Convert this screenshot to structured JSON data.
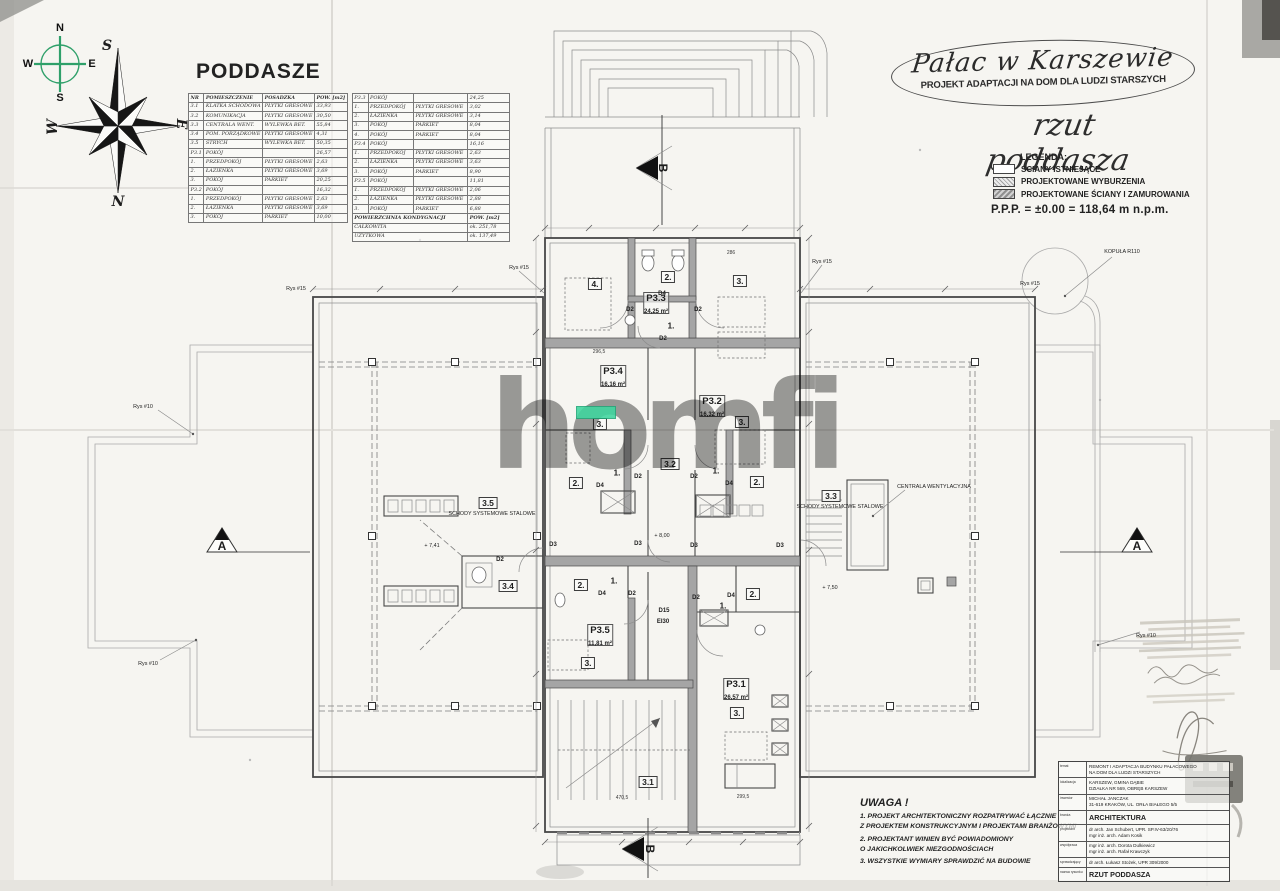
{
  "colors": {
    "highlight_green": "#3fd69f",
    "compass_green": "#2fa06a",
    "watermark_gray": "#868686"
  },
  "compass": {
    "n": "N",
    "e": "E",
    "s": "S",
    "w": "W"
  },
  "attic_table": {
    "title": "PODDASZE",
    "headers": [
      "NR",
      "POMIESZCZENIE",
      "POSADZKA",
      "POW. [m2]"
    ],
    "left_rows": [
      [
        "3.1",
        "KLATKA SCHODOWA",
        "PŁYTKI GRESOWE",
        "33,93"
      ],
      [
        "3.2",
        "KOMUNIKACJA",
        "PŁYTKI GRESOWE",
        "30,50"
      ],
      [
        "3.3",
        "CENTRALA WENT.",
        "WYLEWKA BET.",
        "55,84"
      ],
      [
        "3.4",
        "POM. PORZĄDKOWE",
        "PŁYTKI GRESOWE",
        "4,31"
      ],
      [
        "3.5",
        "STRYCH",
        "WYLEWKA BET.",
        "50,35"
      ],
      [
        "P3.1",
        "POKÓJ",
        "",
        "26,57"
      ],
      [
        "1.",
        "PRZEDPOKÓJ",
        "PŁYTKI GRESOWE",
        "2,63"
      ],
      [
        "2.",
        "ŁAZIENKA",
        "PŁYTKI GRESOWE",
        "3,69"
      ],
      [
        "3.",
        "POKÓJ",
        "PARKIET",
        "20,25"
      ],
      [
        "P3.2",
        "POKÓJ",
        "",
        "16,32"
      ],
      [
        "1.",
        "PRZEDPOKÓJ",
        "PŁYTKI GRESOWE",
        "2,63"
      ],
      [
        "2.",
        "ŁAZIENKA",
        "PŁYTKI GRESOWE",
        "3,69"
      ],
      [
        "3.",
        "POKÓJ",
        "PARKIET",
        "10,00"
      ]
    ],
    "right_rows": [
      [
        "P3.3",
        "POKÓJ",
        "",
        "24,25"
      ],
      [
        "1.",
        "PRZEDPOKÓJ",
        "PŁYTKI GRESOWE",
        "3,02"
      ],
      [
        "2.",
        "ŁAZIENKA",
        "PŁYTKI GRESOWE",
        "3,14"
      ],
      [
        "3.",
        "POKÓJ",
        "PARKIET",
        "8,04"
      ],
      [
        "4.",
        "POKÓJ",
        "PARKIET",
        "8,04"
      ],
      [
        "P3.4",
        "POKÓJ",
        "",
        "16,16"
      ],
      [
        "1.",
        "PRZEDPOKÓJ",
        "PŁYTKI GRESOWE",
        "2,63"
      ],
      [
        "2.",
        "ŁAZIENKA",
        "PŁYTKI GRESOWE",
        "3,63"
      ],
      [
        "3.",
        "POKÓJ",
        "PARKIET",
        "8,90"
      ],
      [
        "P3.5",
        "POKÓJ",
        "",
        "11,81"
      ],
      [
        "1.",
        "PRZEDPOKÓJ",
        "PŁYTKI GRESOWE",
        "2,06"
      ],
      [
        "2.",
        "ŁAZIENKA",
        "PŁYTKI GRESOWE",
        "2,88"
      ],
      [
        "3.",
        "POKÓJ",
        "PARKIET",
        "6,88"
      ]
    ],
    "summary": {
      "head": "POWIERZCHNIA KONDYGNACJI",
      "unit": "POW. [m2]",
      "rows": [
        [
          "CAŁKOWITA",
          "ok. 251,78"
        ],
        [
          "UŻYTKOWA",
          "ok. 137,49"
        ]
      ]
    }
  },
  "header": {
    "project_title": "Pałac w Karszewie",
    "project_subtitle": "PROJEKT ADAPTACJI NA DOM DLA LUDZI STARSZYCH",
    "drawing_title": "rzut poddasza",
    "legend": {
      "title": "LEGENDA:",
      "items": [
        {
          "label": "ŚCIANY ISTNIEJĄCE",
          "cls": "existing"
        },
        {
          "label": "PROJEKTOWANE WYBURZENIA",
          "cls": "demolition"
        },
        {
          "label": "PROJEKTOWANE ŚCIANY I ZAMUROWANIA",
          "cls": "newwalls"
        }
      ]
    },
    "level_note": "P.P.P. =  ±0.00 = 118,64 m n.p.m."
  },
  "plan": {
    "watermark": "homfi",
    "labels": [
      {
        "text": "S",
        "x": 107,
        "y": 46,
        "cls": "bl"
      },
      {
        "text": "N",
        "x": 118,
        "y": 202,
        "cls": "bl"
      },
      {
        "text": "W",
        "x": 53,
        "y": 127,
        "cls": "bl rotneg"
      },
      {
        "text": "E",
        "x": 181,
        "y": 124,
        "cls": "bl rot"
      },
      {
        "text": "Rys #15",
        "x": 296,
        "y": 289,
        "cls": "tiny"
      },
      {
        "text": "Rys #15",
        "x": 519,
        "y": 268,
        "cls": "tiny"
      },
      {
        "text": "Rys #15",
        "x": 822,
        "y": 262,
        "cls": "tiny"
      },
      {
        "text": "Rys #15",
        "x": 1030,
        "y": 284,
        "cls": "tiny"
      },
      {
        "text": "KOPUŁA R110",
        "x": 1122,
        "y": 252,
        "cls": "tiny"
      },
      {
        "text": "Rys #10",
        "x": 143,
        "y": 407,
        "cls": "tiny"
      },
      {
        "text": "Rys #10",
        "x": 148,
        "y": 664,
        "cls": "tiny"
      },
      {
        "text": "Rys #10",
        "x": 1146,
        "y": 636,
        "cls": "tiny"
      },
      {
        "text": "4.",
        "x": 595,
        "y": 284,
        "cls": "boxed"
      },
      {
        "text": "2.",
        "x": 668,
        "y": 277,
        "cls": "boxed"
      },
      {
        "text": "3.",
        "x": 740,
        "y": 281,
        "cls": "boxed"
      },
      {
        "text": "P3.3",
        "x": 656,
        "y": 303,
        "cls": "rm"
      },
      {
        "text": "24,25 m²",
        "x": 656,
        "y": 312,
        "cls": "area"
      },
      {
        "text": "D4",
        "x": 662,
        "y": 294,
        "cls": "dlab"
      },
      {
        "text": "D2",
        "x": 630,
        "y": 310,
        "cls": "dlab"
      },
      {
        "text": "D2",
        "x": 698,
        "y": 310,
        "cls": "dlab"
      },
      {
        "text": "1.",
        "x": 671,
        "y": 326,
        "cls": "num"
      },
      {
        "text": "D2",
        "x": 663,
        "y": 339,
        "cls": "dlab"
      },
      {
        "text": "296,5",
        "x": 599,
        "y": 352,
        "cls": "dim"
      },
      {
        "text": "286",
        "x": 731,
        "y": 253,
        "cls": "dim"
      },
      {
        "text": "P3.4",
        "x": 613,
        "y": 376,
        "cls": "rm"
      },
      {
        "text": "16,16 m²",
        "x": 613,
        "y": 385,
        "cls": "area"
      },
      {
        "text": "P3.2",
        "x": 712,
        "y": 406,
        "cls": "rm"
      },
      {
        "text": "16,32 m²",
        "x": 712,
        "y": 415,
        "cls": "area"
      },
      {
        "text": "3.",
        "x": 600,
        "y": 424,
        "cls": "boxed"
      },
      {
        "text": "3.",
        "x": 742,
        "y": 422,
        "cls": "boxed"
      },
      {
        "text": "3.2",
        "x": 670,
        "y": 464,
        "cls": "boxed"
      },
      {
        "text": "2.",
        "x": 576,
        "y": 483,
        "cls": "boxed"
      },
      {
        "text": "1.",
        "x": 617,
        "y": 473,
        "cls": "num"
      },
      {
        "text": "D4",
        "x": 600,
        "y": 486,
        "cls": "dlab"
      },
      {
        "text": "D2",
        "x": 638,
        "y": 477,
        "cls": "dlab"
      },
      {
        "text": "D2",
        "x": 694,
        "y": 477,
        "cls": "dlab"
      },
      {
        "text": "1.",
        "x": 716,
        "y": 471,
        "cls": "num"
      },
      {
        "text": "D4",
        "x": 729,
        "y": 484,
        "cls": "dlab"
      },
      {
        "text": "2.",
        "x": 757,
        "y": 482,
        "cls": "boxed"
      },
      {
        "text": "+ 8,00",
        "x": 662,
        "y": 536,
        "cls": "tiny"
      },
      {
        "text": "D3",
        "x": 553,
        "y": 545,
        "cls": "dlab"
      },
      {
        "text": "D3",
        "x": 638,
        "y": 544,
        "cls": "dlab"
      },
      {
        "text": "D3",
        "x": 694,
        "y": 546,
        "cls": "dlab"
      },
      {
        "text": "D3",
        "x": 780,
        "y": 546,
        "cls": "dlab"
      },
      {
        "text": "3.5",
        "x": 488,
        "y": 503,
        "cls": "boxed"
      },
      {
        "text": "SCHODY SYSTEMOWE STALOWE",
        "x": 492,
        "y": 514,
        "cls": "tiny"
      },
      {
        "text": "+ 7,41",
        "x": 432,
        "y": 546,
        "cls": "tiny"
      },
      {
        "text": "D2",
        "x": 500,
        "y": 560,
        "cls": "dlab"
      },
      {
        "text": "3.4",
        "x": 508,
        "y": 586,
        "cls": "boxed"
      },
      {
        "text": "3.3",
        "x": 831,
        "y": 496,
        "cls": "boxed"
      },
      {
        "text": "SCHODY SYSTEMOWE STALOWE",
        "x": 840,
        "y": 507,
        "cls": "tiny"
      },
      {
        "text": "CENTRALA WENTYLACYJNA",
        "x": 934,
        "y": 487,
        "cls": "tiny"
      },
      {
        "text": "+ 7,50",
        "x": 830,
        "y": 588,
        "cls": "tiny"
      },
      {
        "text": "2.",
        "x": 581,
        "y": 585,
        "cls": "boxed"
      },
      {
        "text": "1.",
        "x": 614,
        "y": 581,
        "cls": "num"
      },
      {
        "text": "D4",
        "x": 602,
        "y": 594,
        "cls": "dlab"
      },
      {
        "text": "D2",
        "x": 632,
        "y": 594,
        "cls": "dlab"
      },
      {
        "text": "D2",
        "x": 696,
        "y": 598,
        "cls": "dlab"
      },
      {
        "text": "1.",
        "x": 723,
        "y": 606,
        "cls": "num"
      },
      {
        "text": "D4",
        "x": 731,
        "y": 596,
        "cls": "dlab"
      },
      {
        "text": "2.",
        "x": 753,
        "y": 594,
        "cls": "boxed"
      },
      {
        "text": "D15",
        "x": 664,
        "y": 611,
        "cls": "dlab"
      },
      {
        "text": "EI30",
        "x": 663,
        "y": 622,
        "cls": "dlab"
      },
      {
        "text": "P3.5",
        "x": 600,
        "y": 635,
        "cls": "rm"
      },
      {
        "text": "11,81 m²",
        "x": 600,
        "y": 644,
        "cls": "area"
      },
      {
        "text": "3.",
        "x": 588,
        "y": 663,
        "cls": "boxed"
      },
      {
        "text": "P3.1",
        "x": 736,
        "y": 689,
        "cls": "rm"
      },
      {
        "text": "26,57 m²",
        "x": 736,
        "y": 698,
        "cls": "area"
      },
      {
        "text": "3.",
        "x": 737,
        "y": 713,
        "cls": "boxed"
      },
      {
        "text": "3.1",
        "x": 648,
        "y": 782,
        "cls": "boxed"
      },
      {
        "text": "470,5",
        "x": 622,
        "y": 798,
        "cls": "dim"
      },
      {
        "text": "299,5",
        "x": 743,
        "y": 797,
        "cls": "dim"
      },
      {
        "text": "A",
        "x": 222,
        "y": 546,
        "cls": "marker"
      },
      {
        "text": "A",
        "x": 1137,
        "y": 546,
        "cls": "marker"
      },
      {
        "text": "B",
        "x": 663,
        "y": 168,
        "cls": "marker rot"
      },
      {
        "text": "B",
        "x": 650,
        "y": 849,
        "cls": "marker rot"
      }
    ]
  },
  "notes": {
    "title": "UWAGA !",
    "items": [
      "1.  PROJEKT ARCHITEKTONICZNY ROZPATRYWAĆ ŁĄCZNIE\nZ PROJEKTEM KONSTRUKCYJNYM I PROJEKTAMI BRANŻOWYMI",
      "2. PROJEKTANT WINIEN BYĆ POWIADOMIONY\nO JAKICHKOLWIEK NIEZGODNOŚCIACH",
      "3. WSZYSTKIE WYMIARY SPRAWDZIĆ NA BUDOWIE"
    ]
  },
  "titleblock": {
    "rows": [
      {
        "label": "temat",
        "value": "REMONT I ADAPTACJA BUDYNKU PAŁACOWEGO\nNA DOM DLA LUDZI STARSZYCH"
      },
      {
        "label": "lokalizacja",
        "value": "KARSZEW, GMINA DĄBIE\nDZIAŁKA NR 569, OBRĘB KARSZEW"
      },
      {
        "label": "inwestor",
        "value": "MICHAŁ JANCZAK\n31-619 KRAKÓW, UL. ORŁA BIAŁEGO 5/5"
      },
      {
        "label": "branża",
        "value": "ARCHITEKTURA",
        "cls": "big"
      },
      {
        "label": "projektant",
        "value": "dr arch. Jan Schubert, UPR. SP.IV-63/20/76\nmgr inż. arch. Adam Kosik"
      },
      {
        "label": "współpraca",
        "value": "mgr inż. arch. Dorota Dulkiewicz\nmgr inż. arch. Rafał Krawczyk"
      },
      {
        "label": "sprawdzający",
        "value": "dr arch. Łukasz Stożek, UPR 309/2000"
      },
      {
        "label": "nazwa rysunku",
        "value": "RZUT PODDASZA",
        "cls": "big"
      }
    ]
  }
}
